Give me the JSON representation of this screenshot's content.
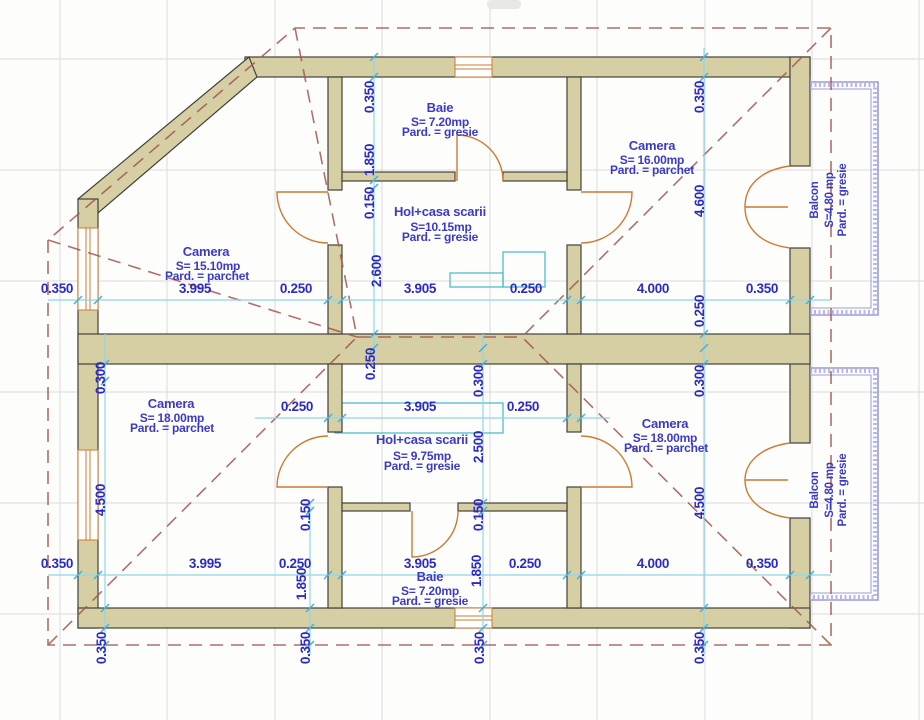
{
  "rooms": {
    "baie_top": {
      "name": "Baie",
      "area": "S= 7.20mp",
      "floor": "Pard. = gresie"
    },
    "camera_top_right": {
      "name": "Camera",
      "area": "S= 16.00mp",
      "floor": "Pard. = parchet"
    },
    "hol_top": {
      "name": "Hol+casa scarii",
      "area": "S=10.15mp",
      "floor": "Pard. = gresie"
    },
    "camera_left": {
      "name": "Camera",
      "area": "S= 15.10mp",
      "floor": "Pard. = parchet"
    },
    "camera_bottom_left": {
      "name": "Camera",
      "area": "S= 18.00mp",
      "floor": "Pard. = parchet"
    },
    "hol_bottom": {
      "name": "Hol+casa scarii",
      "area": "S= 9.75mp",
      "floor": "Pard. = gresie"
    },
    "camera_bottom_right": {
      "name": "Camera",
      "area": "S= 18.00mp",
      "floor": "Pard. = parchet"
    },
    "baie_bottom": {
      "name": "Baie",
      "area": "S= 7.20mp",
      "floor": "Pard. = gresie"
    },
    "balcon_top": {
      "name": "Balcon",
      "area": "S=4.80 mp",
      "floor": "Pard. = gresie"
    },
    "balcon_bottom": {
      "name": "Balcon",
      "area": "S=4.80 mp",
      "floor": "Pard. = gresie"
    }
  },
  "dims": {
    "rows": {
      "top": [
        "0.350",
        "3.995",
        "0.250",
        "3.905",
        "0.250",
        "4.000",
        "0.350"
      ],
      "mid": [
        "0.250",
        "3.905",
        "0.250"
      ],
      "bottom": [
        "0.350",
        "3.995",
        "0.250",
        "3.905",
        "0.250",
        "4.000",
        "0.350"
      ]
    },
    "cols": {
      "center_upper": [
        "0.350",
        "1.850",
        "0.150",
        "2.600",
        "0.250"
      ],
      "center_lower": [
        "0.300",
        "2.500",
        "0.150",
        "1.850"
      ],
      "hall_left_lower": [
        "0.150",
        "1.850"
      ],
      "left": [
        "0.300",
        "4.500"
      ],
      "right": [
        "0.350",
        "4.600",
        "0.250",
        "0.300",
        "4.500"
      ],
      "bottom_offsets": [
        "0.350",
        "0.350",
        "0.350",
        "0.350"
      ]
    }
  },
  "colors": {
    "wall_fill": "#d7cfa4",
    "wall_edge": "#44403a",
    "dim_text": "#2b2bc4",
    "room_text": "#3a3ac6",
    "dim_line": "#8ed6e6",
    "tick": "#45b0dc",
    "door": "#cc7a33",
    "roof_dash": "#a2584e",
    "balcony_rail": "#9a9ade",
    "grid": "#dcdcdc",
    "stair": "#3fb8c8"
  }
}
